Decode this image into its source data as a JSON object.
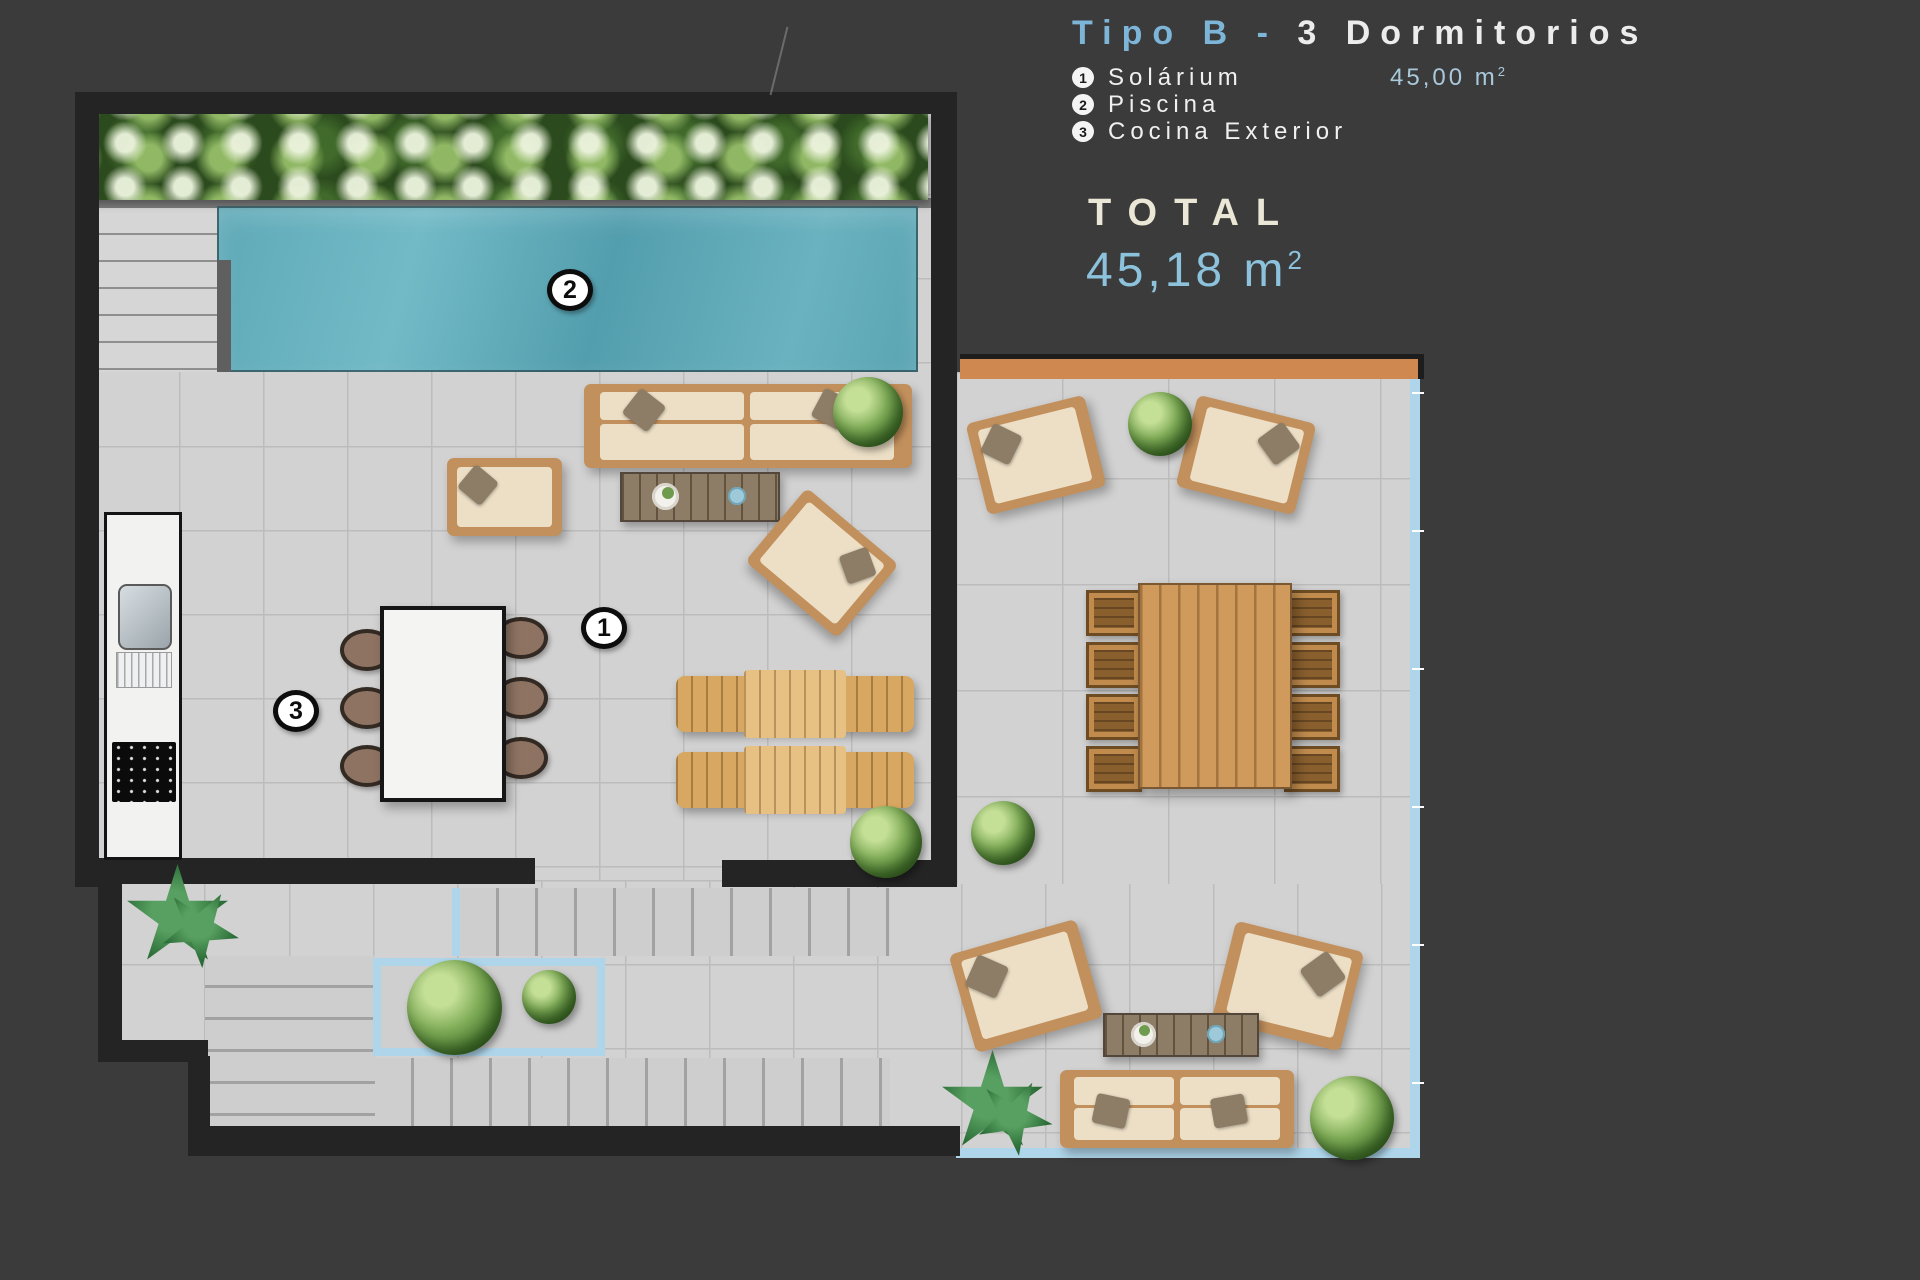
{
  "header": {
    "title": {
      "highlight": "Tipo B -",
      "rest": "3 Dormitorios"
    },
    "legend": [
      {
        "num": "1",
        "label": "Solárium",
        "area": "45,00 m",
        "area_sup": "2"
      },
      {
        "num": "2",
        "label": "Piscina",
        "area": "",
        "area_sup": ""
      },
      {
        "num": "3",
        "label": "Cocina Exterior",
        "area": "",
        "area_sup": ""
      }
    ],
    "total": {
      "label": "TOTAL",
      "value": "45,18 m",
      "sup": "2"
    }
  },
  "plan": {
    "markers": [
      {
        "id": "solarium",
        "num": "1"
      },
      {
        "id": "piscina",
        "num": "2"
      },
      {
        "id": "cocina-exterior",
        "num": "3"
      }
    ]
  },
  "colors": {
    "background": "#3b3b3b",
    "wall": "#242424",
    "floor": "#d2d2d2",
    "pool": "#5fa9b7",
    "hedge_green": "#2b4a1d",
    "title_blue": "#7db5d8",
    "accent_blue": "#8cc2dc",
    "cream": "#ebe7d6",
    "cyan_border": "#aed5ea",
    "beam_orange": "#cf8850",
    "wood": "#c2905c"
  }
}
